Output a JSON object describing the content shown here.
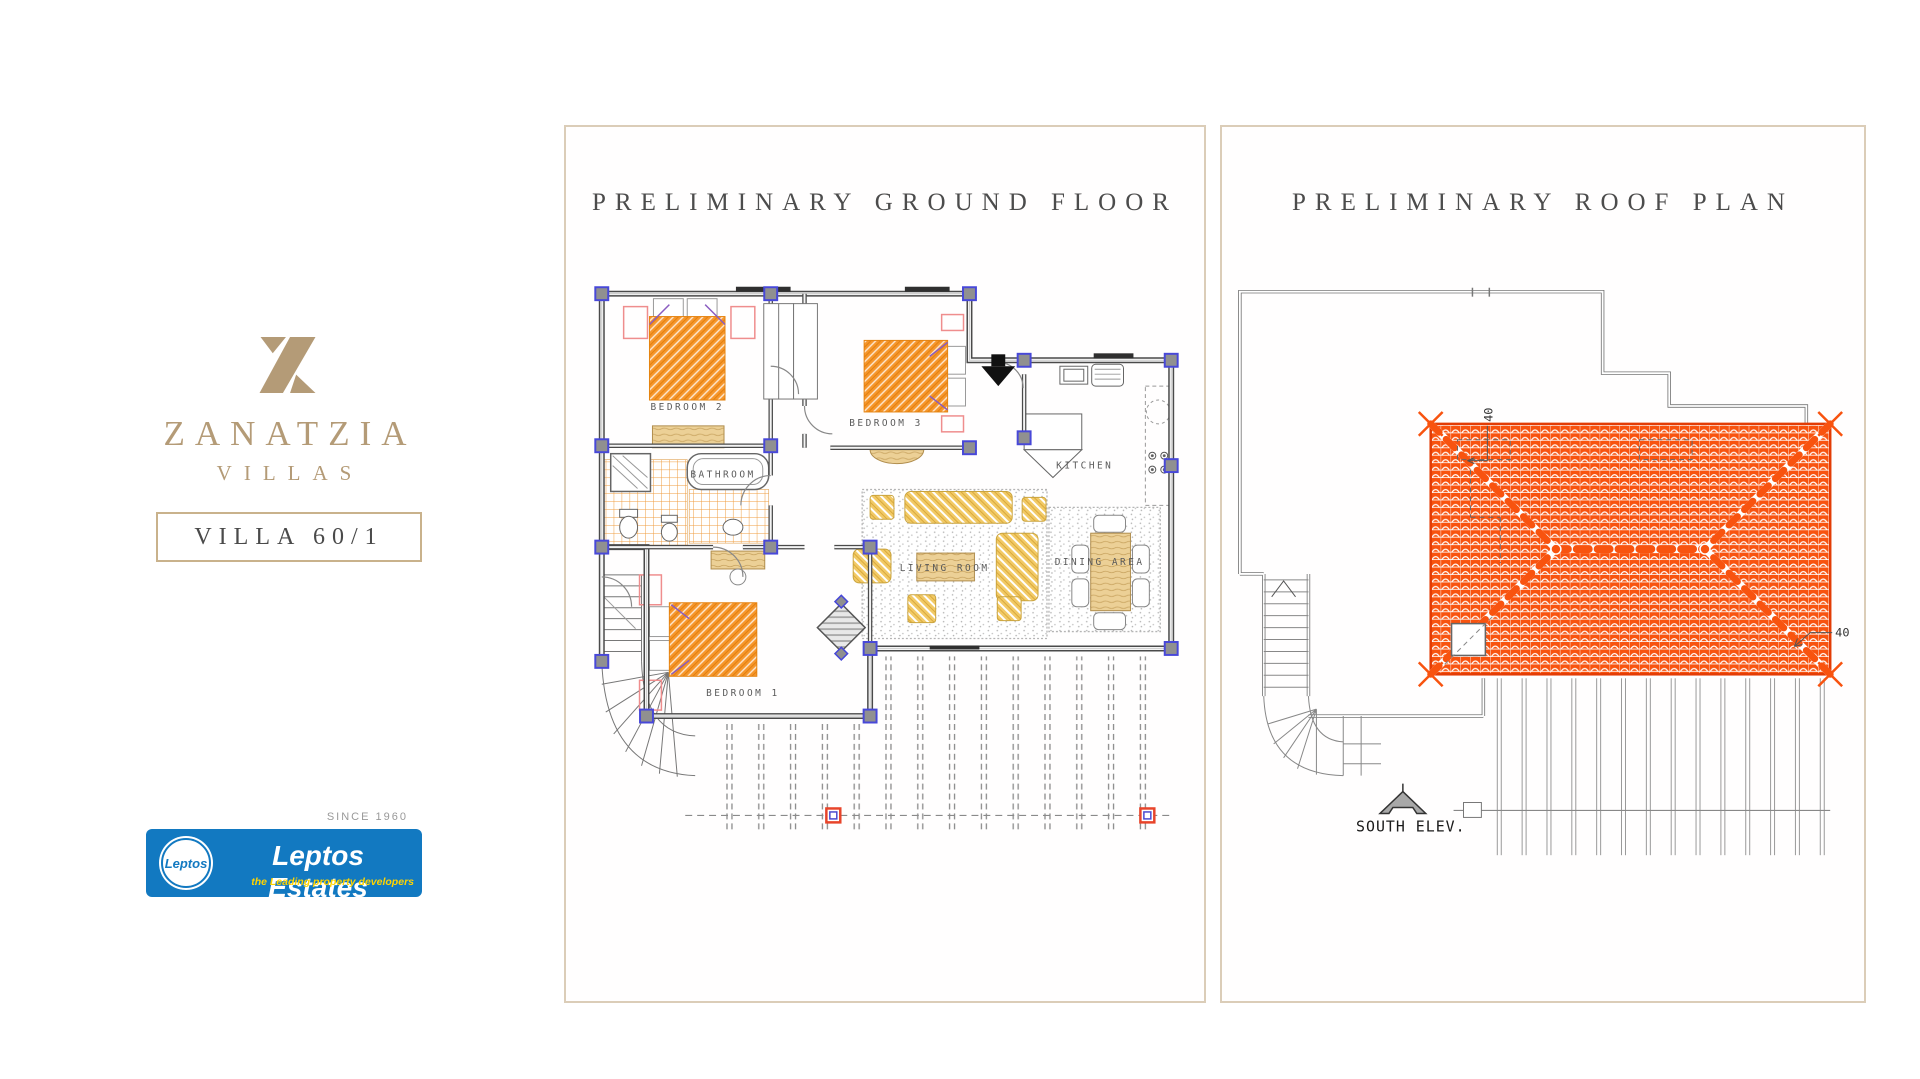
{
  "brand": {
    "logo": "zanatzia-monogram",
    "name": "ZANATZIA",
    "type": "VILLAS",
    "villa": "VILLA 60/1",
    "gold": "#b49b77"
  },
  "developer": {
    "since": "SINCE 1960",
    "badge": "Leptos",
    "name": "Leptos Estates",
    "tagline": "the Leading property developers",
    "blue": "#1279c1",
    "yellow": "#ffd400"
  },
  "panels": {
    "ground_title": "PRELIMINARY GROUND FLOOR",
    "roof_title": "PRELIMINARY ROOF PLAN"
  },
  "floor_plan_labels": {
    "bedroom2": "BEDROOM 2",
    "bedroom3": "BEDROOM 3",
    "bathroom": "BATHROOM",
    "kitchen": "KITCHEN",
    "living": "LIVING ROOM",
    "dining": "DINING AREA",
    "bedroom1": "BEDROOM 1"
  },
  "roof_plan_labels": {
    "south": "SOUTH ELEV.",
    "dim_top": "40",
    "dim_right": "40"
  },
  "colors": {
    "panel_border": "#dbcdb8",
    "roof_tile": "#f8530f",
    "bed_orange": "#f6962b",
    "furniture_yellow": "#f2ca66",
    "wall_gray": "#4a4a4a",
    "column_blue": "#4848d8",
    "tile_grid_orange": "#ef9d3f"
  }
}
